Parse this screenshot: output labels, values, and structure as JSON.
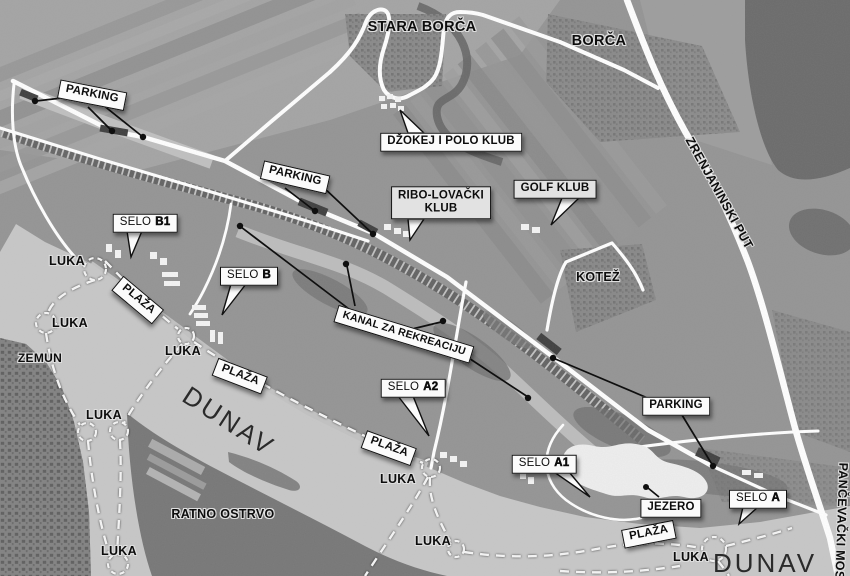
{
  "map": {
    "region_labels": {
      "stara_borca": "STARA BORČA",
      "borca": "BORČA",
      "kotez": "KOTEŽ",
      "zemun": "ZEMUN",
      "ratno_ostrvo": "RATNO OSTRVO",
      "dunav": "DUNAV",
      "zrenjaninski_put": "ZRENJANINSKI PUT",
      "pancevacki_most": "PANČEVAČKI MOST"
    },
    "poi_labels": {
      "parking": "PARKING",
      "luka": "LUKA",
      "plaza": "PLAŽA",
      "jezero": "JEZERO",
      "golf_klub": "GOLF KLUB",
      "dzokej_i_polo_klub": "DŽOKEJ I POLO KLUB",
      "ribo_lovacki_line1": "RIBO-LOVAČKI",
      "ribo_lovacki_line2": "KLUB",
      "kanal_za_rekreaciju": "KANAL ZA REKREACIJU",
      "selo": "SELO",
      "selo_a": "A",
      "selo_a1": "A1",
      "selo_a2": "A2",
      "selo_b": "B",
      "selo_b1": "B1"
    },
    "colors": {
      "water": "#c7c7c7",
      "land": "#949494",
      "road": "#ffffff",
      "route": "#f2f2f2",
      "label_box_bg": "#fbfbfb",
      "club_box_bg": "#e2e2e2",
      "label_border": "#111111",
      "ink": "#0d0d0d"
    }
  }
}
